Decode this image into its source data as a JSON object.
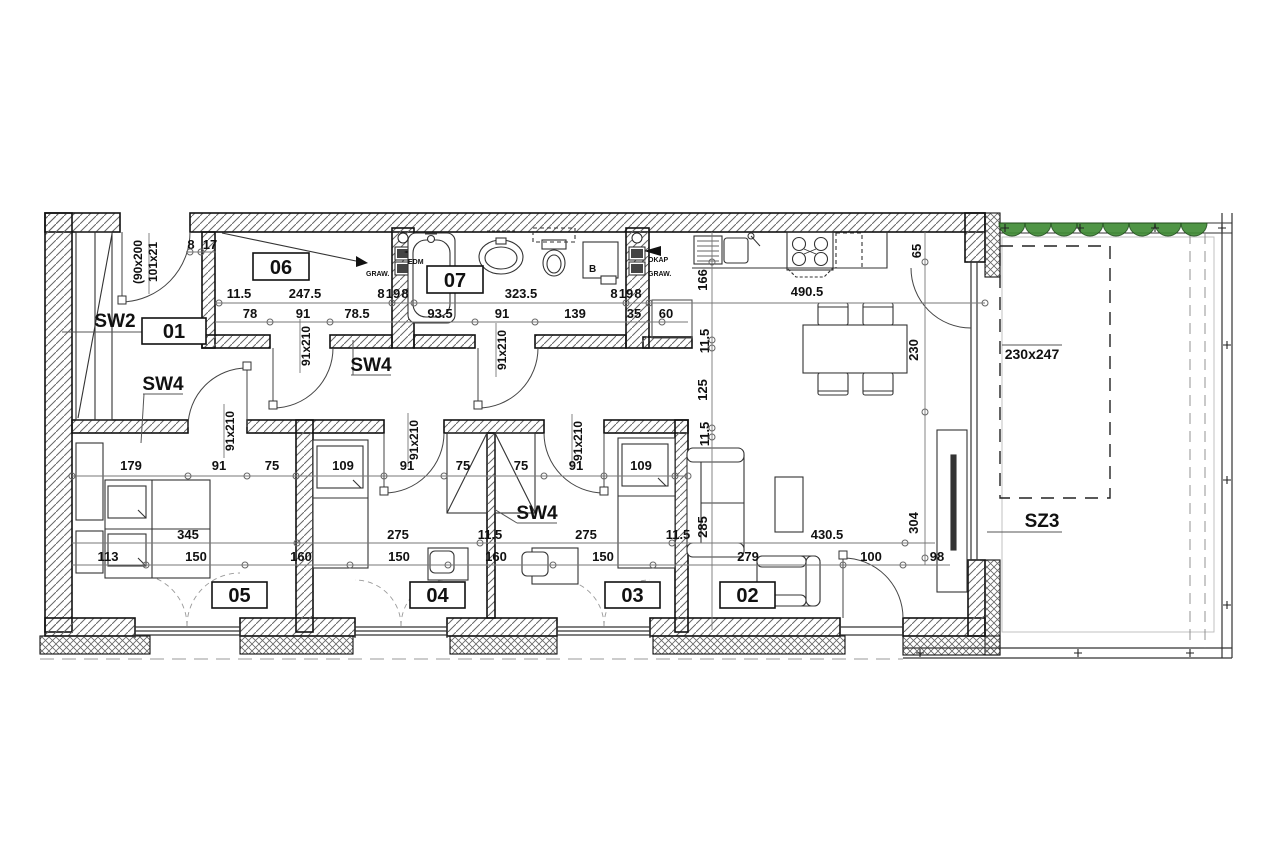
{
  "drawing_type": "architectural-floor-plan",
  "colors": {
    "line": "#1a1a1a",
    "dim_text": "#111111",
    "hatch": "#666666",
    "plant_green": "#3e8a33",
    "light_line": "#999999"
  },
  "rooms": [
    {
      "id": "01",
      "x": 142,
      "y": 318,
      "w": 64,
      "h": 26
    },
    {
      "id": "06",
      "x": 253,
      "y": 253,
      "w": 56,
      "h": 27
    },
    {
      "id": "07",
      "x": 427,
      "y": 266,
      "w": 56,
      "h": 27
    },
    {
      "id": "05",
      "x": 212,
      "y": 582,
      "w": 55,
      "h": 26
    },
    {
      "id": "04",
      "x": 410,
      "y": 582,
      "w": 55,
      "h": 26
    },
    {
      "id": "03",
      "x": 605,
      "y": 582,
      "w": 55,
      "h": 26
    },
    {
      "id": "02",
      "x": 720,
      "y": 582,
      "w": 55,
      "h": 26
    }
  ],
  "wall_labels": [
    {
      "text": "SW2",
      "x": 115,
      "y": 327
    },
    {
      "text": "SW4",
      "x": 163,
      "y": 390
    },
    {
      "text": "SW4",
      "x": 371,
      "y": 371
    },
    {
      "text": "SW4",
      "x": 537,
      "y": 519
    },
    {
      "text": "SZ3",
      "x": 1042,
      "y": 527
    }
  ],
  "door_labels": [
    {
      "text": "91x210",
      "x": 310,
      "y": 346
    },
    {
      "text": "91x210",
      "x": 506,
      "y": 350
    },
    {
      "text": "91x210",
      "x": 234,
      "y": 431
    },
    {
      "text": "91x210",
      "x": 418,
      "y": 440
    },
    {
      "text": "91x210",
      "x": 582,
      "y": 441
    }
  ],
  "entrance_labels": [
    {
      "text": "(90x200",
      "x": 142,
      "y": 262
    },
    {
      "text": "101x21",
      "x": 157,
      "y": 262
    }
  ],
  "window_label": {
    "text": "230x247",
    "x": 1032,
    "y": 359
  },
  "dims_h": [
    {
      "t": "11.5",
      "x": 239,
      "y": 298
    },
    {
      "t": "247.5",
      "x": 305,
      "y": 298
    },
    {
      "t": "8",
      "x": 381,
      "y": 298
    },
    {
      "t": "19",
      "x": 393,
      "y": 298
    },
    {
      "t": "8",
      "x": 405,
      "y": 298
    },
    {
      "t": "323.5",
      "x": 521,
      "y": 298
    },
    {
      "t": "8",
      "x": 614,
      "y": 298
    },
    {
      "t": "19",
      "x": 626,
      "y": 298
    },
    {
      "t": "8",
      "x": 638,
      "y": 298
    },
    {
      "t": "490.5",
      "x": 807,
      "y": 296
    },
    {
      "t": "78",
      "x": 250,
      "y": 318
    },
    {
      "t": "91",
      "x": 303,
      "y": 318
    },
    {
      "t": "78.5",
      "x": 357,
      "y": 318
    },
    {
      "t": "93.5",
      "x": 440,
      "y": 318
    },
    {
      "t": "91",
      "x": 502,
      "y": 318
    },
    {
      "t": "139",
      "x": 575,
      "y": 318
    },
    {
      "t": "35",
      "x": 634,
      "y": 318
    },
    {
      "t": "60",
      "x": 666,
      "y": 318
    },
    {
      "t": "179",
      "x": 131,
      "y": 470
    },
    {
      "t": "91",
      "x": 219,
      "y": 470
    },
    {
      "t": "75",
      "x": 272,
      "y": 470
    },
    {
      "t": "109",
      "x": 343,
      "y": 470
    },
    {
      "t": "91",
      "x": 407,
      "y": 470
    },
    {
      "t": "75",
      "x": 463,
      "y": 470
    },
    {
      "t": "75",
      "x": 521,
      "y": 470
    },
    {
      "t": "91",
      "x": 576,
      "y": 470
    },
    {
      "t": "109",
      "x": 641,
      "y": 470
    },
    {
      "t": "345",
      "x": 188,
      "y": 539
    },
    {
      "t": "275",
      "x": 398,
      "y": 539
    },
    {
      "t": "11.5",
      "x": 490,
      "y": 539
    },
    {
      "t": "275",
      "x": 586,
      "y": 539
    },
    {
      "t": "11.5",
      "x": 678,
      "y": 539
    },
    {
      "t": "430.5",
      "x": 827,
      "y": 539
    },
    {
      "t": "113",
      "x": 108,
      "y": 561
    },
    {
      "t": "150",
      "x": 196,
      "y": 561
    },
    {
      "t": "160",
      "x": 301,
      "y": 561
    },
    {
      "t": "150",
      "x": 399,
      "y": 561
    },
    {
      "t": "160",
      "x": 496,
      "y": 561
    },
    {
      "t": "150",
      "x": 603,
      "y": 561
    },
    {
      "t": "279",
      "x": 748,
      "y": 561
    },
    {
      "t": "100",
      "x": 871,
      "y": 561
    },
    {
      "t": "98",
      "x": 937,
      "y": 561
    },
    {
      "t": "8",
      "x": 191,
      "y": 249
    },
    {
      "t": "17",
      "x": 210,
      "y": 249
    }
  ],
  "dims_v": [
    {
      "t": "166",
      "x": 707,
      "y": 280
    },
    {
      "t": "11.5",
      "x": 709,
      "y": 341
    },
    {
      "t": "125",
      "x": 707,
      "y": 390
    },
    {
      "t": "11.5",
      "x": 709,
      "y": 434
    },
    {
      "t": "285",
      "x": 707,
      "y": 527
    },
    {
      "t": "65",
      "x": 921,
      "y": 251
    },
    {
      "t": "230",
      "x": 918,
      "y": 350
    },
    {
      "t": "304",
      "x": 918,
      "y": 523
    }
  ],
  "small_texts": [
    {
      "t": "GRAW.",
      "x": 366,
      "y": 276,
      "s": 7
    },
    {
      "t": "OKAP",
      "x": 648,
      "y": 262,
      "s": 7
    },
    {
      "t": "GRAW.",
      "x": 648,
      "y": 276,
      "s": 7
    },
    {
      "t": "EDM",
      "x": 408,
      "y": 264,
      "s": 7
    },
    {
      "t": "B",
      "x": 589,
      "y": 272,
      "s": 10
    }
  ],
  "ticks": [
    [
      219,
      303
    ],
    [
      392,
      303
    ],
    [
      414,
      303
    ],
    [
      626,
      303
    ],
    [
      649,
      303
    ],
    [
      985,
      303
    ],
    [
      270,
      322
    ],
    [
      330,
      322
    ],
    [
      475,
      322
    ],
    [
      535,
      322
    ],
    [
      662,
      322
    ],
    [
      72,
      476
    ],
    [
      188,
      476
    ],
    [
      247,
      476
    ],
    [
      296,
      476
    ],
    [
      384,
      476
    ],
    [
      444,
      476
    ],
    [
      544,
      476
    ],
    [
      604,
      476
    ],
    [
      675,
      476
    ],
    [
      688,
      476
    ],
    [
      297,
      543
    ],
    [
      480,
      543
    ],
    [
      672,
      543
    ],
    [
      905,
      543
    ],
    [
      146,
      565
    ],
    [
      245,
      565
    ],
    [
      350,
      565
    ],
    [
      448,
      565
    ],
    [
      553,
      565
    ],
    [
      653,
      565
    ],
    [
      843,
      565
    ],
    [
      903,
      565
    ],
    [
      712,
      262
    ],
    [
      712,
      340
    ],
    [
      712,
      348
    ],
    [
      712,
      428
    ],
    [
      712,
      437
    ],
    [
      925,
      262
    ],
    [
      925,
      412
    ],
    [
      925,
      558
    ],
    [
      190,
      252
    ],
    [
      201,
      252
    ]
  ],
  "hinge_squares": [
    [
      118,
      296
    ],
    [
      269,
      401
    ],
    [
      474,
      401
    ],
    [
      243,
      362
    ],
    [
      380,
      487
    ],
    [
      600,
      487
    ],
    [
      839,
      551
    ]
  ],
  "terrace": {
    "plants_y": 223,
    "plants_r": 13,
    "plants_x": [
      1012,
      1038,
      1064,
      1090,
      1116,
      1142,
      1168,
      1194
    ],
    "plus_marks": [
      [
        1005,
        228
      ],
      [
        1080,
        228
      ],
      [
        1155,
        228
      ],
      [
        1222,
        228
      ],
      [
        1227,
        345
      ],
      [
        1227,
        480
      ],
      [
        1227,
        605
      ],
      [
        920,
        653
      ],
      [
        1078,
        653
      ],
      [
        1190,
        653
      ]
    ]
  }
}
